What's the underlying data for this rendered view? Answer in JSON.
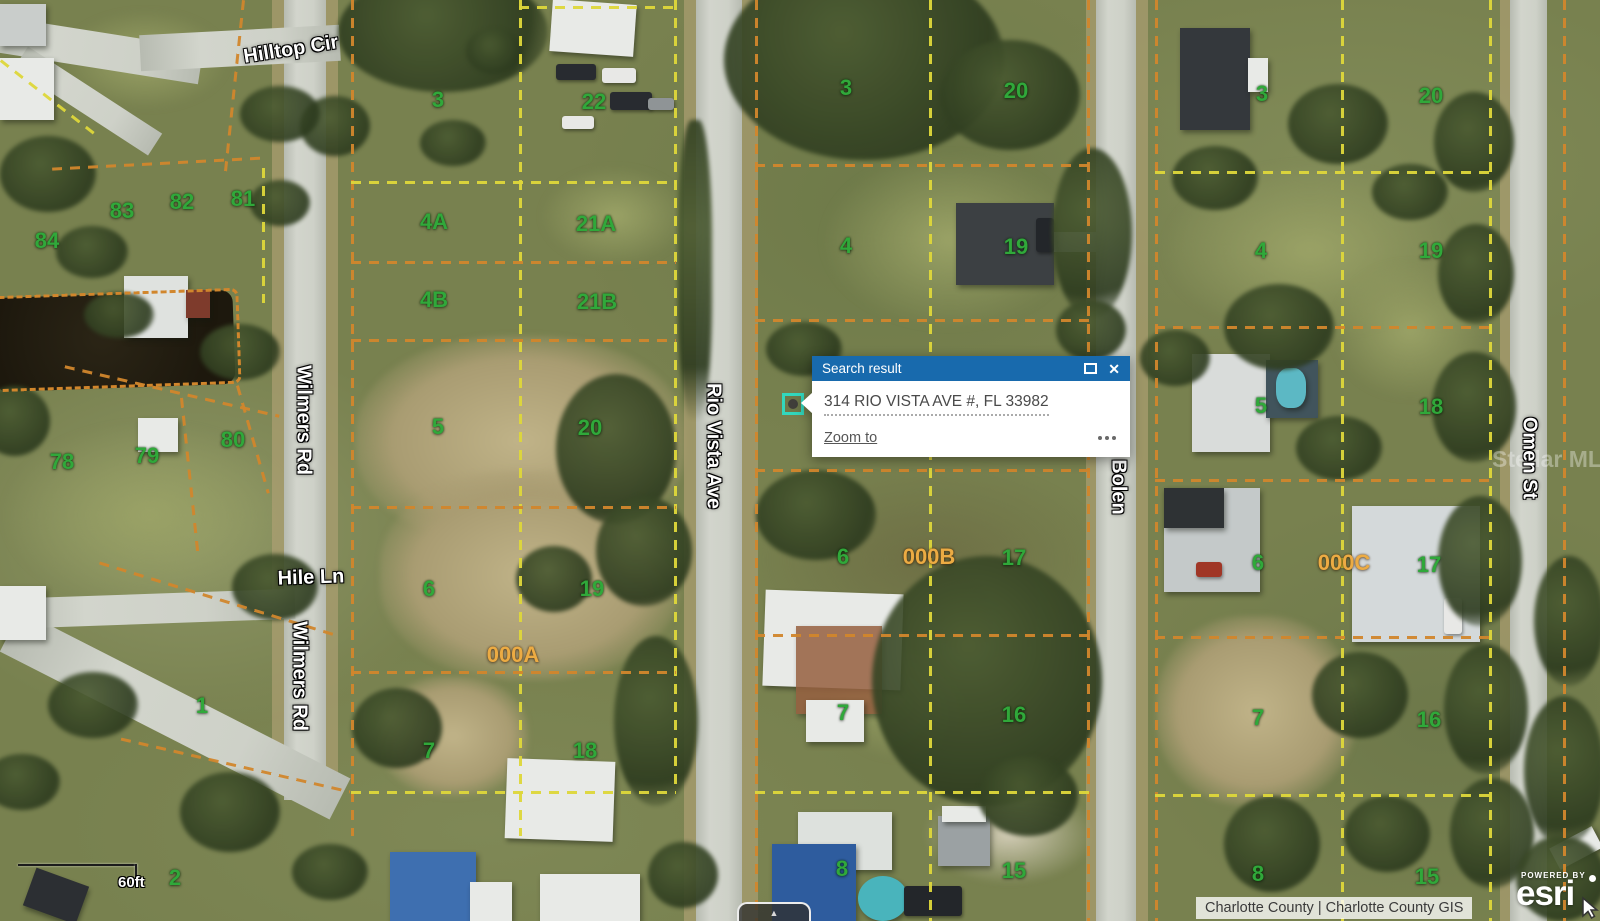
{
  "popup": {
    "title": "Search result",
    "address": "314 RIO VISTA AVE #, FL 33982",
    "zoom_to_label": "Zoom to",
    "close_glyph": "✕",
    "header_color": "#186aad"
  },
  "controls": {
    "expander_glyph": "▲"
  },
  "map_ui": {
    "scale_label": "60ft"
  },
  "attribution": {
    "text": "Charlotte County | Charlotte County GIS",
    "powered_by": "POWERED BY",
    "esri_logo": "esri"
  },
  "watermark": {
    "text": "Stellar MLS"
  },
  "colors": {
    "marker_teal": "#32d7bd",
    "parcel_line_yellow": "#ded73a",
    "parcel_line_orange": "#d1862c",
    "parcel_label_green": "#30a83a",
    "block_label_orange": "#ecab43"
  },
  "map": {
    "street_labels": [
      {
        "text": "Hilltop Cir",
        "x": 291,
        "y": 50,
        "rotate": -9
      },
      {
        "text": "Wilmers Rd",
        "x": 303,
        "y": 420,
        "rotate": 90
      },
      {
        "text": "Hile Ln",
        "x": 311,
        "y": 578,
        "rotate": -2
      },
      {
        "text": "Wilmers Rd",
        "x": 299,
        "y": 676,
        "rotate": 90
      },
      {
        "text": "Rio Vista Ave",
        "x": 713,
        "y": 446,
        "rotate": 90
      },
      {
        "text": "Bolen",
        "x": 1118,
        "y": 487,
        "rotate": 90
      },
      {
        "text": "Omen St",
        "x": 1529,
        "y": 458,
        "rotate": 90
      }
    ],
    "parcel_labels": [
      {
        "t": "84",
        "x": 47,
        "y": 241
      },
      {
        "t": "83",
        "x": 122,
        "y": 211
      },
      {
        "t": "82",
        "x": 182,
        "y": 202
      },
      {
        "t": "81",
        "x": 243,
        "y": 199
      },
      {
        "t": "78",
        "x": 62,
        "y": 462
      },
      {
        "t": "79",
        "x": 147,
        "y": 456
      },
      {
        "t": "80",
        "x": 233,
        "y": 440
      },
      {
        "t": "1",
        "x": 202,
        "y": 706
      },
      {
        "t": "2",
        "x": 175,
        "y": 878
      },
      {
        "t": "3",
        "x": 438,
        "y": 100
      },
      {
        "t": "22",
        "x": 594,
        "y": 102
      },
      {
        "t": "4A",
        "x": 434,
        "y": 222
      },
      {
        "t": "21A",
        "x": 596,
        "y": 224
      },
      {
        "t": "4B",
        "x": 434,
        "y": 300
      },
      {
        "t": "21B",
        "x": 597,
        "y": 302
      },
      {
        "t": "5",
        "x": 438,
        "y": 427
      },
      {
        "t": "20",
        "x": 590,
        "y": 428
      },
      {
        "t": "6",
        "x": 429,
        "y": 589
      },
      {
        "t": "19",
        "x": 592,
        "y": 589
      },
      {
        "t": "000A",
        "x": 513,
        "y": 655,
        "b": true
      },
      {
        "t": "7",
        "x": 429,
        "y": 751
      },
      {
        "t": "18",
        "x": 585,
        "y": 751
      },
      {
        "t": "3",
        "x": 846,
        "y": 88
      },
      {
        "t": "20",
        "x": 1016,
        "y": 91
      },
      {
        "t": "4",
        "x": 846,
        "y": 246
      },
      {
        "t": "19",
        "x": 1016,
        "y": 247
      },
      {
        "t": "6",
        "x": 843,
        "y": 557
      },
      {
        "t": "000B",
        "x": 929,
        "y": 557,
        "b": true
      },
      {
        "t": "17",
        "x": 1014,
        "y": 558
      },
      {
        "t": "7",
        "x": 843,
        "y": 713
      },
      {
        "t": "16",
        "x": 1014,
        "y": 715
      },
      {
        "t": "8",
        "x": 842,
        "y": 869
      },
      {
        "t": "15",
        "x": 1014,
        "y": 871
      },
      {
        "t": "3",
        "x": 1262,
        "y": 94
      },
      {
        "t": "20",
        "x": 1431,
        "y": 96
      },
      {
        "t": "4",
        "x": 1261,
        "y": 251
      },
      {
        "t": "19",
        "x": 1431,
        "y": 251
      },
      {
        "t": "5",
        "x": 1261,
        "y": 406
      },
      {
        "t": "18",
        "x": 1431,
        "y": 407
      },
      {
        "t": "6",
        "x": 1258,
        "y": 563
      },
      {
        "t": "000C",
        "x": 1344,
        "y": 563,
        "b": true
      },
      {
        "t": "17",
        "x": 1429,
        "y": 565
      },
      {
        "t": "7",
        "x": 1258,
        "y": 718
      },
      {
        "t": "16",
        "x": 1429,
        "y": 720
      },
      {
        "t": "8",
        "x": 1258,
        "y": 874
      },
      {
        "t": "15",
        "x": 1427,
        "y": 877
      }
    ]
  }
}
